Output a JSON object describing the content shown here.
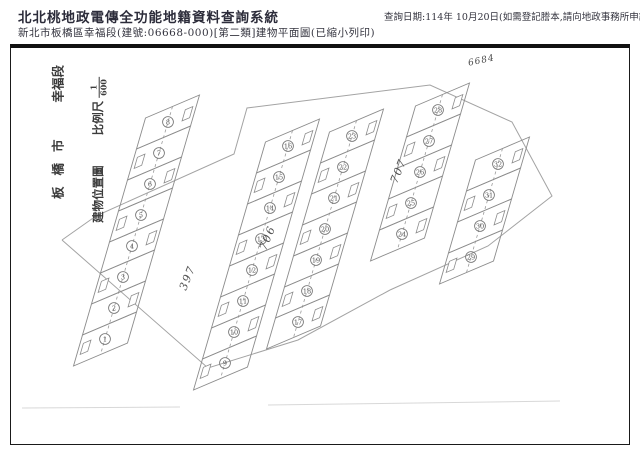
{
  "header": {
    "system_title": "北北桃地政電傳全功能地籍資料查詢系統",
    "document_title": "新北市板橋區幸福段(建號:06668-000)[第二類]建物平面圖(已縮小列印)",
    "query_date_line": "查詢日期:114年 10月20日(如需登記謄本,請向地政事務所申請。)"
  },
  "plan": {
    "location_label": {
      "city": "板橋市",
      "section": "幸福段"
    },
    "map_label": {
      "title": "建物位置圖",
      "scale_label": "比例尺",
      "scale_numerator": "1",
      "scale_denominator": "600"
    },
    "annotation": "6684",
    "road_labels": [
      {
        "text": "397",
        "x": 186,
        "y": 291,
        "rot": -68
      },
      {
        "text": "706",
        "x": 266,
        "y": 251,
        "rot": -68
      },
      {
        "text": "707",
        "x": 397,
        "y": 184,
        "rot": -68
      }
    ],
    "geometry": {
      "unit_step": [
        -9,
        31
      ],
      "width_vec": [
        54,
        -23
      ],
      "strips": [
        {
          "name": "strip-a",
          "anchor": [
            168,
            122
          ],
          "units": [
            "8",
            "7",
            "6",
            "5",
            "4",
            "3",
            "2",
            "1"
          ]
        },
        {
          "name": "strip-b",
          "anchor": [
            288,
            146
          ],
          "units": [
            "16",
            "15",
            "14",
            "13",
            "12",
            "11",
            "10",
            "9"
          ]
        },
        {
          "name": "strip-c",
          "anchor": [
            352,
            136
          ],
          "units": [
            "23",
            "22",
            "21",
            "20",
            "19",
            "18",
            "17"
          ]
        },
        {
          "name": "strip-d",
          "anchor": [
            438,
            110
          ],
          "units": [
            "28",
            "27",
            "26",
            "25",
            "24"
          ]
        },
        {
          "name": "strip-e",
          "anchor": [
            498,
            164
          ],
          "units": [
            "32",
            "31",
            "30",
            "29"
          ]
        }
      ],
      "boundary": [
        [
          [
            96,
            216
          ],
          [
            234,
            154
          ],
          [
            247,
            108
          ],
          [
            430,
            85
          ],
          [
            512,
            122
          ],
          [
            552,
            196
          ],
          [
            488,
            246
          ],
          [
            390,
            290
          ]
        ],
        [
          [
            62,
            240
          ],
          [
            208,
            368
          ],
          [
            298,
            340
          ],
          [
            390,
            290
          ]
        ],
        [
          [
            96,
            216
          ],
          [
            62,
            240
          ]
        ]
      ],
      "faint_lines": [
        [
          [
            22,
            408
          ],
          [
            180,
            407
          ]
        ],
        [
          [
            268,
            405
          ],
          [
            560,
            401
          ]
        ]
      ]
    },
    "colors": {
      "cell_line": "#8c8c8c",
      "dash_line": "#9a9a9a",
      "circle_line": "#6f6f6f",
      "number_text": "#555555",
      "boundary_line": "#a3a3a3",
      "faint_line": "#d8d8d8",
      "road_text": "#4f4f4f"
    }
  }
}
